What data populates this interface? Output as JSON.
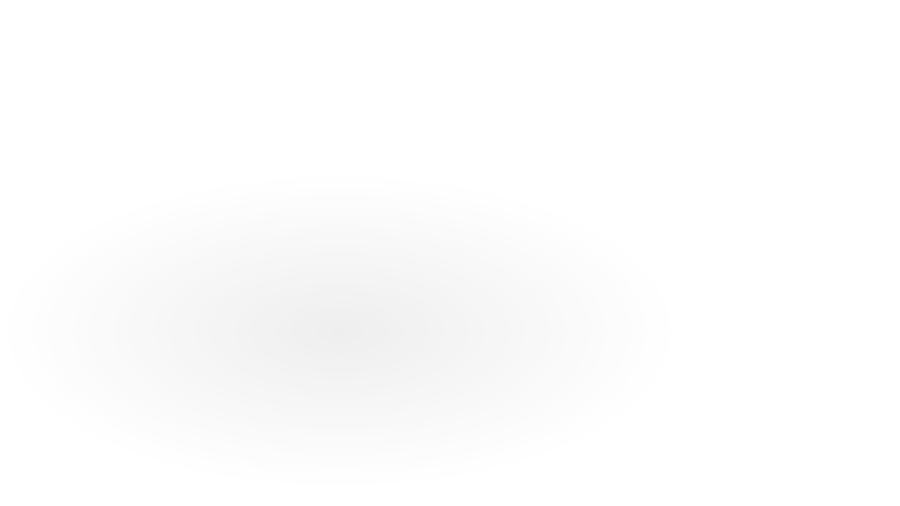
{
  "title": "Stacked GIS map layers illustration",
  "description": "Isometric illustration of three stacked map layers of the same city area: a vector land-use map on top, aerial imagery with magenta building-footprint overlay in the middle, and plain aerial imagery at the bottom.",
  "layers": [
    {
      "name": "Vector land-use map layer",
      "type": "vector",
      "position": "top",
      "colors": {
        "park_green": "#25cf4a",
        "building_pink": "#fb1798",
        "block_gray": "#3b3c42",
        "street_dark": "#2a2b31",
        "water_blue": "#2767e8",
        "ground_tan": "#b49a80",
        "path_olive": "#5f574a",
        "poi_orange": "#f79118"
      }
    },
    {
      "name": "Aerial imagery with building-footprint overlay",
      "type": "hybrid",
      "position": "middle",
      "colors": {
        "footprint_pink": "#fb1798",
        "roof_dark": "#20242e",
        "street_tan": "#b3a284",
        "ground_tan": "#8f7c63",
        "water_gray": "#4a555a",
        "tree_dark": "#43402e"
      }
    },
    {
      "name": "Aerial imagery base layer",
      "type": "raster",
      "position": "bottom",
      "colors": {
        "ground_tan": "#8f7c63",
        "roof_dark": "#20242e",
        "street_tan": "#b3a284",
        "water_gray": "#4a555a",
        "tree_dark": "#43402e",
        "building_white": "#c9cdd2",
        "pool_cyan": "#6fd0e8"
      }
    }
  ],
  "plate_edge_color": "#c3b296",
  "background_color": "#ffffff"
}
